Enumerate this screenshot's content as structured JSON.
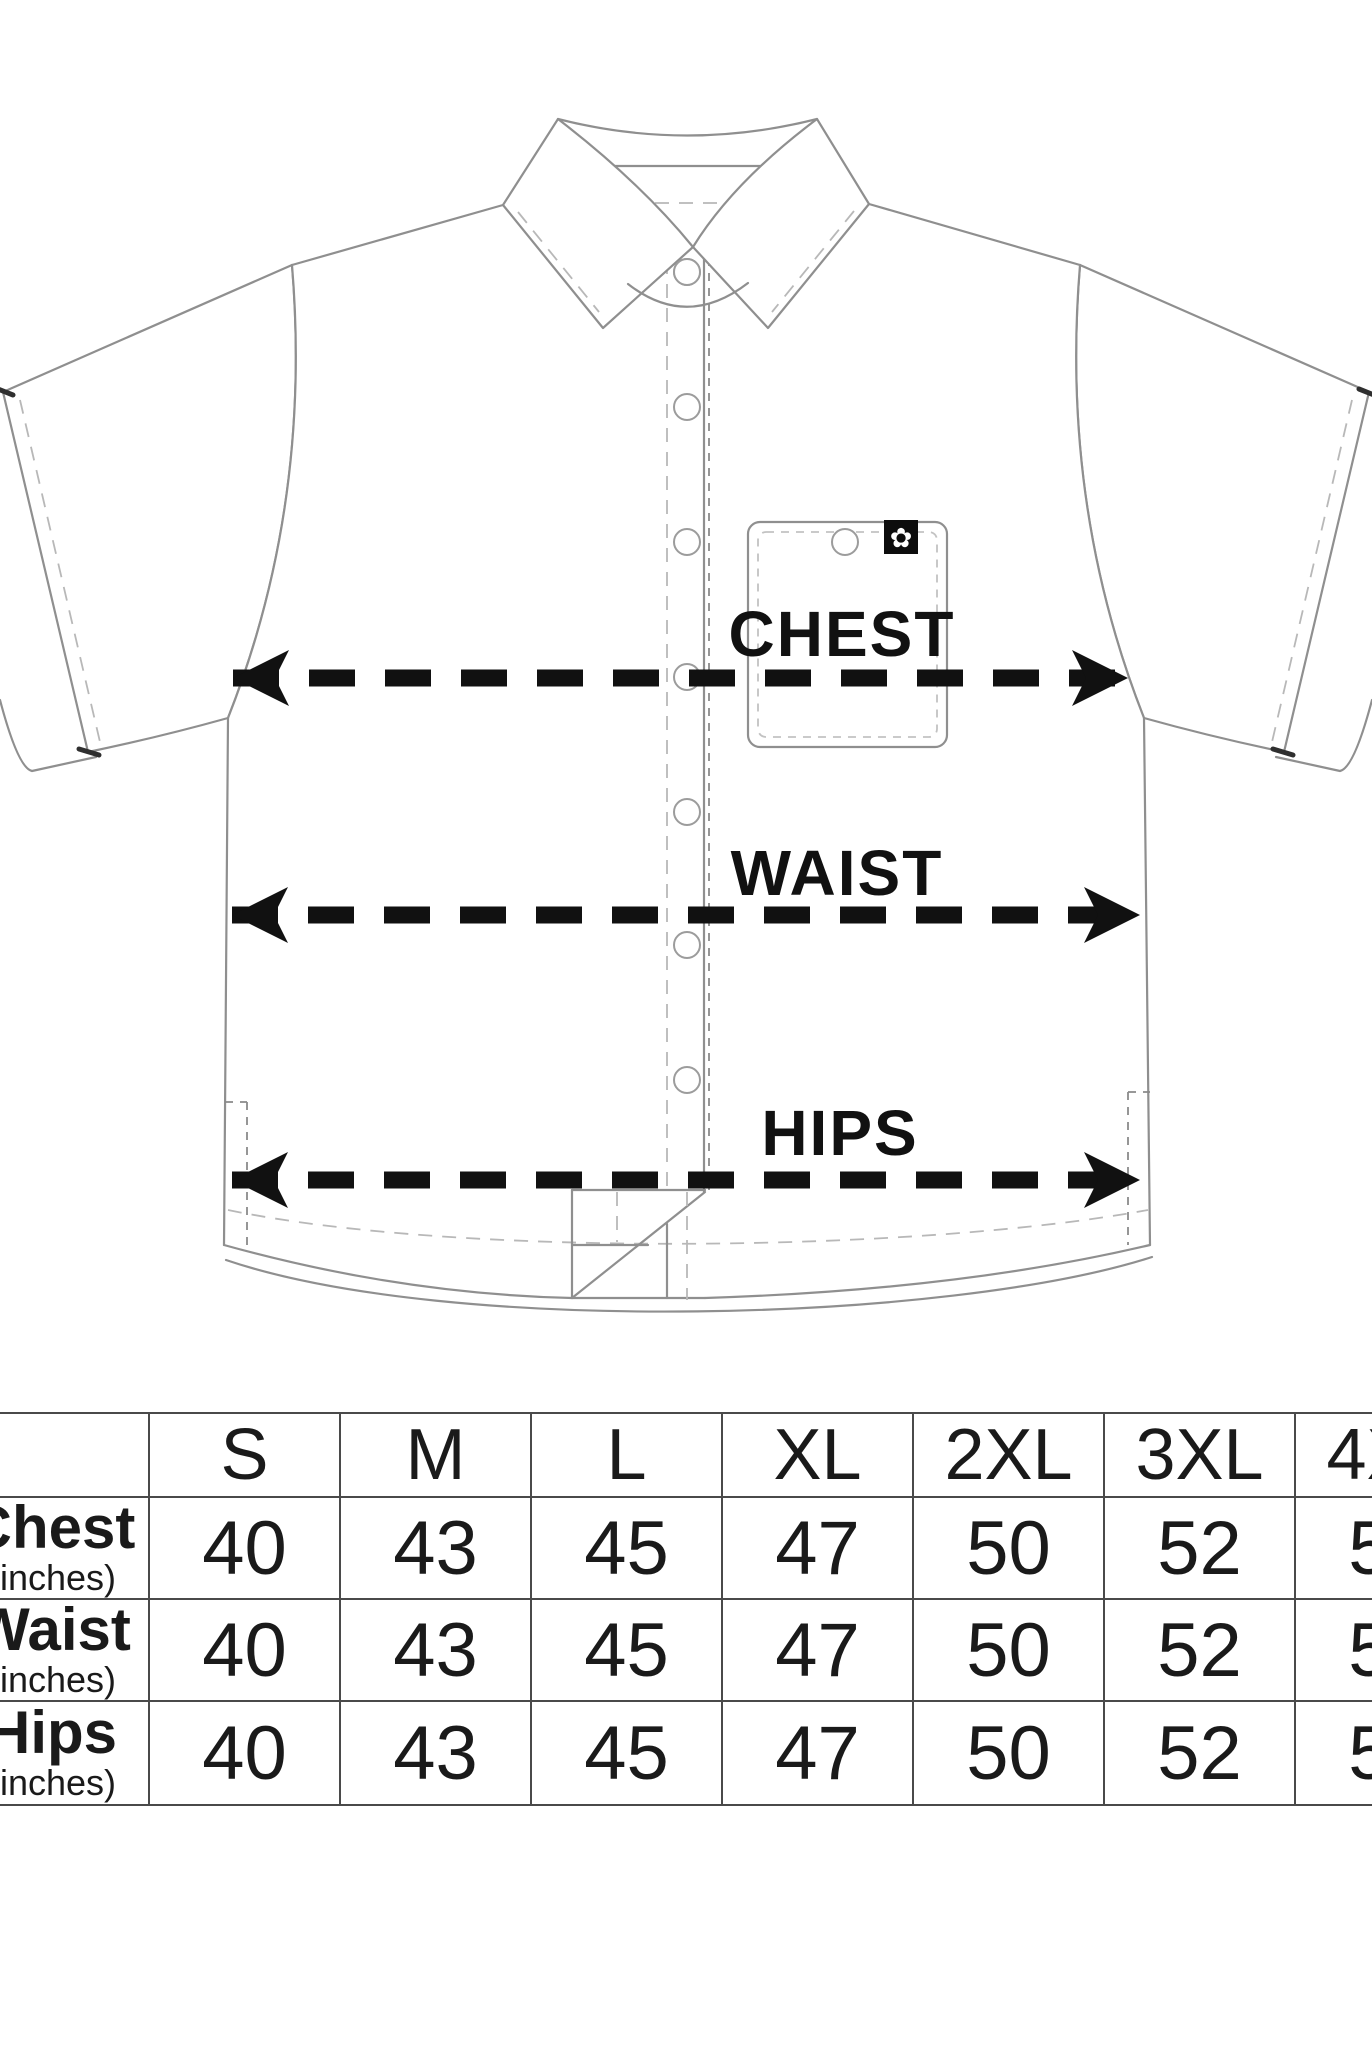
{
  "page": {
    "background": "#ffffff"
  },
  "diagram": {
    "garment": "short-sleeve-button-up-shirt",
    "measurement_labels": [
      {
        "id": "chest",
        "text": "CHEST"
      },
      {
        "id": "waist",
        "text": "WAIST"
      },
      {
        "id": "hips",
        "text": "HIPS"
      }
    ],
    "pocket_logo_glyph": "✿",
    "button_count": 7,
    "colors": {
      "outline": "#8f8f8f",
      "stitch": "#b8b8b8",
      "ink": "#111111",
      "logo_patch": "#0d0d0d"
    }
  },
  "size_table": {
    "columns": [
      "S",
      "M",
      "L",
      "XL",
      "2XL",
      "3XL",
      "4XL"
    ],
    "rows": [
      {
        "label": "Chest",
        "unit": "(inches)",
        "values": [
          "40",
          "43",
          "45",
          "47",
          "50",
          "52",
          "55"
        ]
      },
      {
        "label": "Waist",
        "unit": "(inches)",
        "values": [
          "40",
          "43",
          "45",
          "47",
          "50",
          "52",
          "55"
        ]
      },
      {
        "label": "Hips",
        "unit": "(inches)",
        "values": [
          "40",
          "43",
          "45",
          "47",
          "50",
          "52",
          "55"
        ]
      }
    ],
    "grid_color": "#4a4a4a",
    "text_color": "#1a1a1a"
  }
}
